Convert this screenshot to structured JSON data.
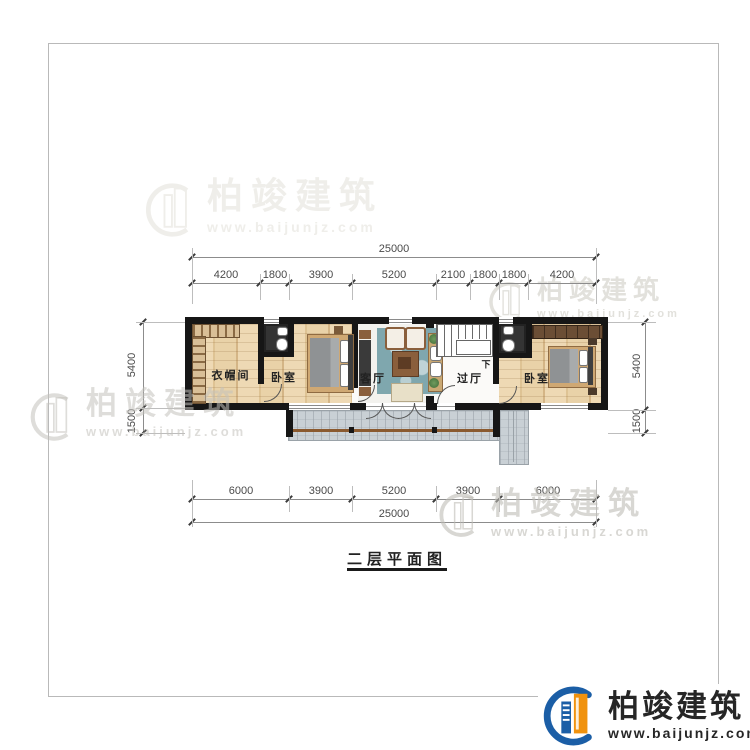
{
  "drawing": {
    "title": "二层平面图",
    "rooms": {
      "cloakroom": "衣帽间",
      "bedroom_left": "卧室",
      "living_room": "客厅",
      "hall": "过厅",
      "bedroom_right": "卧室",
      "stair_direction": "下"
    },
    "dimensions": {
      "top_total": "25000",
      "top_segments": [
        "4200",
        "1800",
        "3900",
        "5200",
        "2100",
        "1800",
        "1800",
        "4200"
      ],
      "bottom_segments": [
        "6000",
        "3900",
        "5200",
        "3900",
        "6000"
      ],
      "bottom_total": "25000",
      "left_segments": [
        "5400",
        "1500"
      ],
      "right_segments": [
        "5400",
        "1500"
      ]
    }
  },
  "brand": {
    "name": "柏竣建筑",
    "url": "www.baijunjz.com",
    "blue": "#1b5ea6",
    "orange": "#f0920e"
  }
}
